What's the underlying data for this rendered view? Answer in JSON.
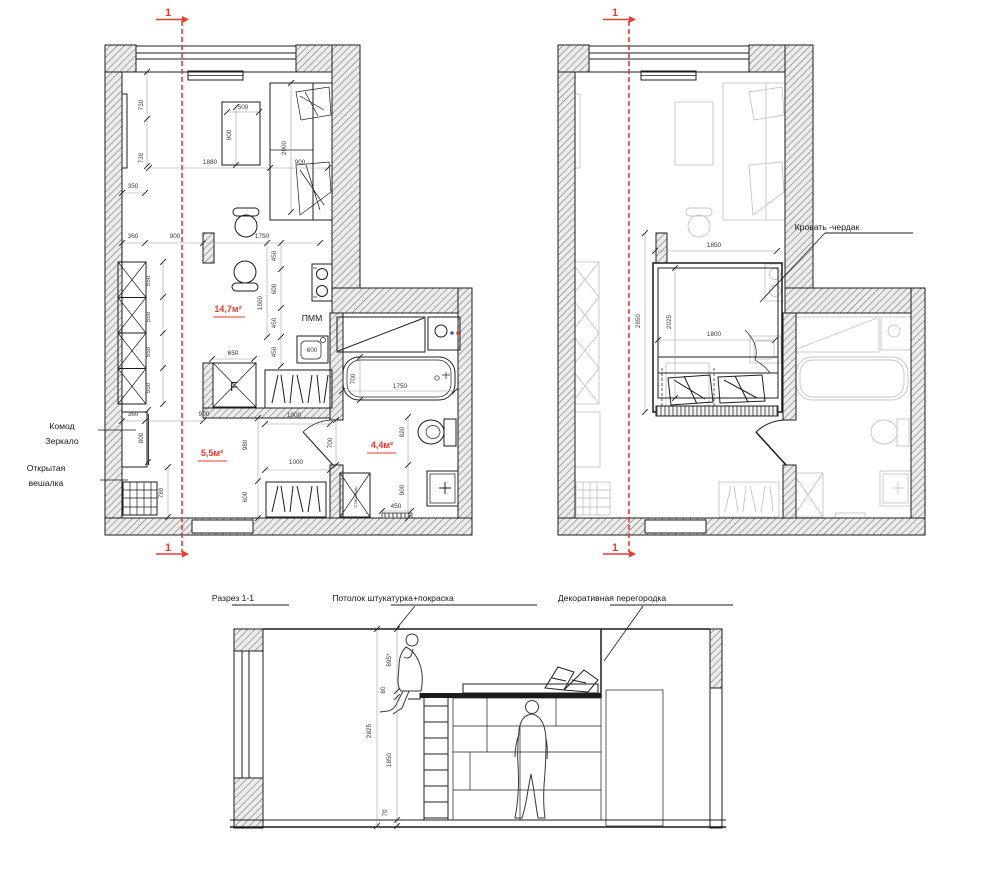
{
  "colors": {
    "accent_red": "#ee3a2e",
    "line_dark": "#1c1c1c",
    "ghost_gray": "#c6c6c6"
  },
  "marks": [
    {
      "t": "1",
      "x": 168,
      "y": 16,
      "c": "mark"
    },
    {
      "t": "1",
      "x": 168,
      "y": 551,
      "c": "mark"
    },
    {
      "t": "1",
      "x": 615,
      "y": 16,
      "c": "mark"
    },
    {
      "t": "1",
      "x": 615,
      "y": 551,
      "c": "mark"
    }
  ],
  "plans": {
    "left": {
      "areas": [
        {
          "t": "14,7м²",
          "x": 228,
          "y": 312,
          "c": "red"
        },
        {
          "t": "5,5м²",
          "x": 212,
          "y": 456,
          "c": "red"
        },
        {
          "t": "4,4м²",
          "x": 382,
          "y": 448,
          "c": "red"
        }
      ],
      "labels": [
        {
          "t": "ПММ",
          "x": 312,
          "y": 321,
          "c": "lbl"
        },
        {
          "t": "Стир.маш",
          "x": 357,
          "y": 497,
          "r": -90,
          "c": "tiny"
        },
        {
          "t": "F",
          "x": 234,
          "y": 391,
          "c": "flabel"
        },
        {
          "t": "Комод",
          "x": 62,
          "y": 429,
          "c": "lbl",
          "a": "start"
        },
        {
          "t": "Зеркало",
          "x": 62,
          "y": 444,
          "c": "lbl",
          "a": "start"
        },
        {
          "t": "Открытая",
          "x": 46,
          "y": 471,
          "c": "lbl",
          "a": "start"
        },
        {
          "t": "вешалка",
          "x": 46,
          "y": 486,
          "c": "lbl",
          "a": "start"
        }
      ],
      "dims": [
        {
          "t": "730",
          "x": 143,
          "y": 105,
          "r": -90
        },
        {
          "t": "730",
          "x": 143,
          "y": 158,
          "r": -90
        },
        {
          "t": "350",
          "x": 133,
          "y": 188
        },
        {
          "t": "500",
          "x": 243,
          "y": 109
        },
        {
          "t": "900",
          "x": 231,
          "y": 135,
          "r": -90
        },
        {
          "t": "1880",
          "x": 210,
          "y": 164
        },
        {
          "t": "2000",
          "x": 286,
          "y": 148,
          "r": -90
        },
        {
          "t": "900",
          "x": 300,
          "y": 164
        },
        {
          "t": "360",
          "x": 133,
          "y": 238
        },
        {
          "t": "900",
          "x": 175,
          "y": 238
        },
        {
          "t": "1750",
          "x": 262,
          "y": 238
        },
        {
          "t": "550",
          "x": 150,
          "y": 281,
          "r": -90
        },
        {
          "t": "550",
          "x": 150,
          "y": 317,
          "r": -90
        },
        {
          "t": "550",
          "x": 150,
          "y": 352,
          "r": -90
        },
        {
          "t": "550",
          "x": 150,
          "y": 388,
          "r": -90
        },
        {
          "t": "450",
          "x": 276,
          "y": 256,
          "r": -90
        },
        {
          "t": "600",
          "x": 276,
          "y": 289,
          "r": -90
        },
        {
          "t": "450",
          "x": 276,
          "y": 323,
          "r": -90
        },
        {
          "t": "450",
          "x": 276,
          "y": 352,
          "r": -90
        },
        {
          "t": "1500",
          "x": 262,
          "y": 303,
          "r": -90
        },
        {
          "t": "650",
          "x": 233,
          "y": 355
        },
        {
          "t": "600",
          "x": 312,
          "y": 352
        },
        {
          "t": "700",
          "x": 355,
          "y": 379,
          "r": -90
        },
        {
          "t": "1750",
          "x": 400,
          "y": 388
        },
        {
          "t": "820",
          "x": 404,
          "y": 432,
          "r": -90
        },
        {
          "t": "700",
          "x": 332,
          "y": 443,
          "r": -90
        },
        {
          "t": "900",
          "x": 404,
          "y": 490,
          "r": -90
        },
        {
          "t": "450",
          "x": 396,
          "y": 508
        },
        {
          "t": "360",
          "x": 133,
          "y": 416
        },
        {
          "t": "900",
          "x": 204,
          "y": 416
        },
        {
          "t": "800",
          "x": 143,
          "y": 438,
          "r": -90
        },
        {
          "t": "780",
          "x": 163,
          "y": 493,
          "r": -90
        },
        {
          "t": "980",
          "x": 247,
          "y": 445,
          "r": -90
        },
        {
          "t": "1000",
          "x": 294,
          "y": 417
        },
        {
          "t": "1000",
          "x": 296,
          "y": 464
        },
        {
          "t": "600",
          "x": 247,
          "y": 497,
          "r": -90
        }
      ]
    },
    "right": {
      "labels": [
        {
          "t": "Кровать -чердак",
          "x": 827,
          "y": 230,
          "c": "lbl",
          "a": "start"
        }
      ],
      "dims": [
        {
          "t": "1850",
          "x": 714,
          "y": 247
        },
        {
          "t": "2650",
          "x": 640,
          "y": 321,
          "r": -90
        },
        {
          "t": "2025",
          "x": 671,
          "y": 322,
          "r": -90
        },
        {
          "t": "1800",
          "x": 714,
          "y": 336
        }
      ]
    }
  },
  "section": {
    "title": [
      {
        "t": "Разрез 1-1",
        "x": 233,
        "y": 601,
        "c": "lbl",
        "a": "start"
      }
    ],
    "labels": [
      {
        "t": "Потолок штукатурка+покраска",
        "x": 393,
        "y": 601,
        "c": "lbl",
        "a": "start"
      },
      {
        "t": "Декоративная перегородка",
        "x": 612,
        "y": 601,
        "c": "lbl",
        "a": "start"
      }
    ],
    "dims": [
      {
        "t": "2825",
        "x": 371,
        "y": 731,
        "r": -90
      },
      {
        "t": "895*",
        "x": 391,
        "y": 660,
        "r": -90
      },
      {
        "t": "80",
        "x": 385,
        "y": 690,
        "r": -90
      },
      {
        "t": "1850",
        "x": 391,
        "y": 760,
        "r": -90
      },
      {
        "t": "70",
        "x": 387,
        "y": 813,
        "r": -90
      }
    ]
  }
}
